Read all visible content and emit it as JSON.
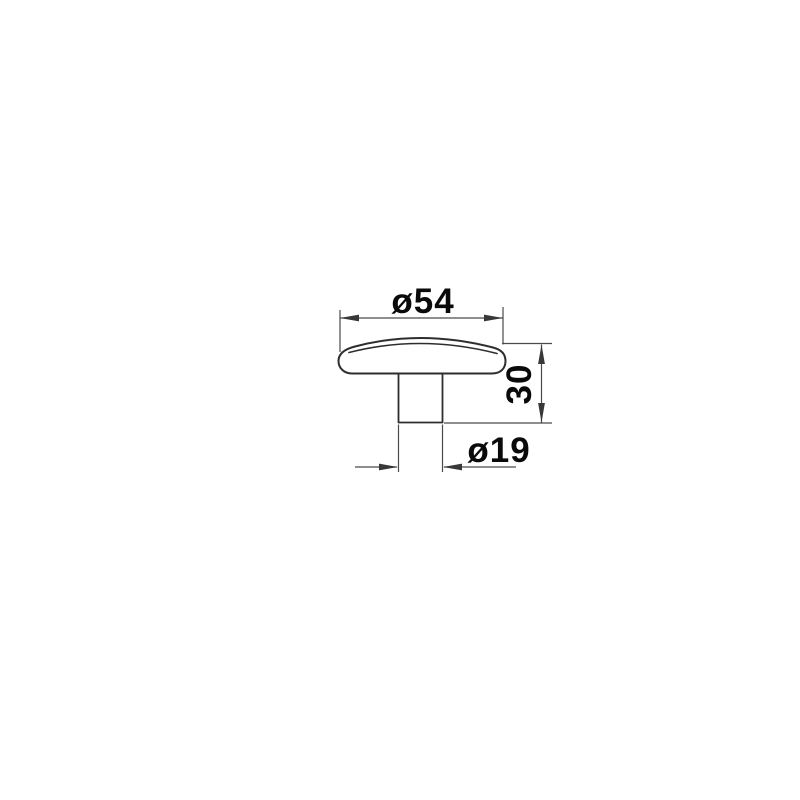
{
  "page": {
    "background_color": "#ffffff"
  },
  "drawing": {
    "type": "technical-dimension-diagram",
    "subject": "mushroom-shaped knob side profile with cap and cylindrical stem",
    "colors": {
      "outline": "#2e2e2e",
      "dimension_lines": "#4a4a4a",
      "text": "#0a0a0a"
    },
    "dimensions": {
      "cap_diameter": {
        "label": "ø54",
        "value": 54,
        "symbol": "diameter",
        "orientation": "horizontal",
        "position": "top"
      },
      "total_height": {
        "label": "30",
        "value": 30,
        "orientation": "vertical",
        "position": "right"
      },
      "stem_diameter": {
        "label": "ø19",
        "value": 19,
        "symbol": "diameter",
        "orientation": "horizontal",
        "position": "bottom"
      }
    }
  }
}
